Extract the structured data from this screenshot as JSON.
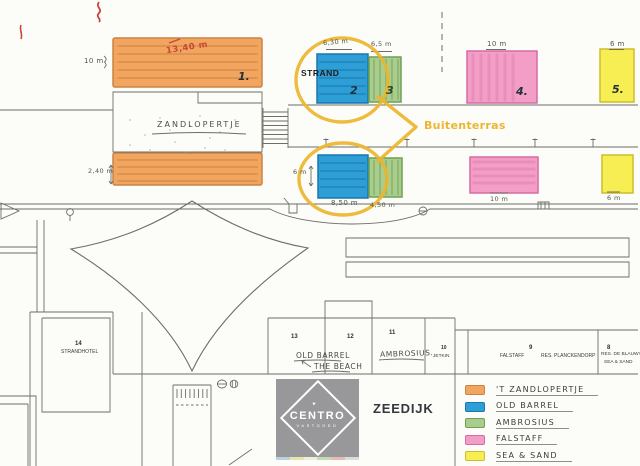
{
  "colors": {
    "orange": "#f2a55e",
    "orange_border": "#c98344",
    "blue": "#2e9ed6",
    "blue_border": "#1977ad",
    "green": "#a8cd8c",
    "green_border": "#6fa054",
    "pink": "#f29ec6",
    "pink_border": "#d66ba3",
    "yellow": "#f6ee52",
    "yellow_border": "#cdbd2e",
    "highlight": "#ecb62f",
    "red_note": "#c8473a",
    "pencil": "#6e6e66",
    "logo_gray": "#98989a",
    "logo_strip": [
      "#b9d2e4",
      "#e9e3ac",
      "#f0eedb",
      "#c5dcb2",
      "#e6bdb4",
      "#dcdcda"
    ]
  },
  "measurements": {
    "orange_top_width": "13,40 m",
    "orange_left_height": "10 m",
    "orange_bottom_height": "2,40 m",
    "blue_top_width": "6,30 m",
    "green_top_width": "6,5 m",
    "pink_top_width": "10 m",
    "yellow_top_width": "6 m",
    "blue_bottom_width": "8,50 m",
    "blue_bottom_height": "6 m",
    "green_bottom_width": "4,50 m",
    "pink_bottom_width": "10 m",
    "yellow_bottom_width": "6 m"
  },
  "units": {
    "orange_number": "1.",
    "blue_number": "2",
    "green_number": "3",
    "pink_number": "4.",
    "yellow_number": "5."
  },
  "labels": {
    "strand": "STRAND",
    "buitenterras": "Buitenterras",
    "zandlopertje_building": "ZANDLOPERTJE"
  },
  "buildings": {
    "strandhotel": {
      "number": "14",
      "name": "STRANDHOTEL"
    },
    "unit13": {
      "number": "13"
    },
    "unit12": {
      "number": "12"
    },
    "unit11": {
      "number": "11"
    },
    "old_barrel_note": "OLD BARREL",
    "the_beach_note": "THE BEACH",
    "ambrosius_note": "AMBROSIUS.",
    "jetkin": {
      "number": "10",
      "name": "JETKIN"
    },
    "falstaff": {
      "number": "9",
      "name": "FALSTAFF",
      "name2": "RES. PLANCKENDORP"
    },
    "blauwvoet": {
      "number": "8",
      "name": "RES. DE BLAUWV",
      "name2": "SEA & SAND"
    }
  },
  "legend": {
    "items": [
      {
        "label": "'T ZANDLOPERTJE",
        "color": "#f2a55e",
        "border": "#c98344"
      },
      {
        "label": "OLD BARREL",
        "color": "#2e9ed6",
        "border": "#1977ad"
      },
      {
        "label": "AMBROSIUS",
        "color": "#a8cd8c",
        "border": "#6fa054"
      },
      {
        "label": "FALSTAFF",
        "color": "#f29ec6",
        "border": "#d66ba3"
      },
      {
        "label": "SEA & SAND",
        "color": "#f6ee52",
        "border": "#cdbd2e"
      }
    ]
  },
  "logo": {
    "brand": "CENTRO",
    "subtitle": "VASTGOED"
  },
  "icons": {
    "logo_arrow": "▸"
  },
  "zeedijk_label": "ZEEDIJK"
}
